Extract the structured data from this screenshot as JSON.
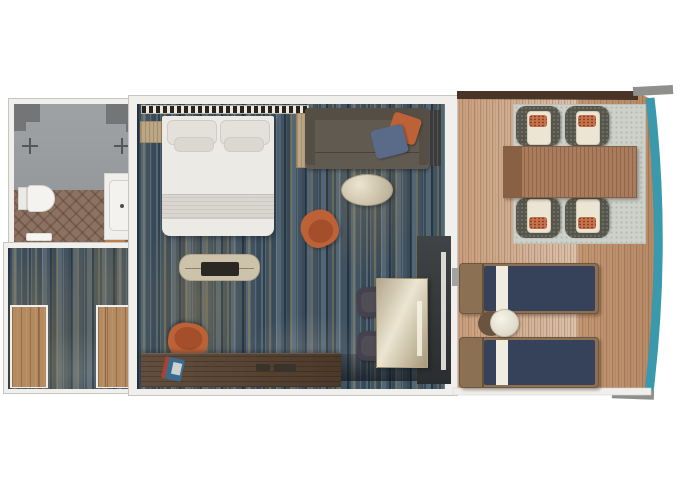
{
  "meta": {
    "type": "floor-plan-render",
    "view": "top-down 3D",
    "visible_text": "none"
  },
  "colors": {
    "bg": "#ffffff",
    "wall": "#f1efec",
    "wall-border": "#c7c5c1",
    "carpet": "#4e606f",
    "bath-floor": "#8c7261",
    "shower": "#9fa2a4",
    "shower-dark": "#737577",
    "threshold-wood": "#c08048",
    "closet-wood": "#b48b61",
    "bed": "#eceae5",
    "bed-shade": "#d9d6cf",
    "sofa": "#615a50",
    "sofa-dark": "#544e44",
    "orange": "#bd6136",
    "pillow-blue": "#596b88",
    "cream": "#cdc3ab",
    "tv": "#2b2824",
    "desk-wood": "#57412e",
    "stool": "#46424d",
    "glass": "#35383b",
    "deck": "#c69d7b",
    "teal": "#3b99ae",
    "brown-band": "#483527",
    "metal": "#8f8f8d",
    "rug": "#cdd1ca",
    "table-wood": "#a97c5d",
    "wicker": "#56564c",
    "cushion": "#ece5d4",
    "pillow-orange": "#c4734c",
    "navy": "#36425a",
    "stripe-cream": "#f0ecdf",
    "frame-wood": "#8c7053"
  },
  "floor_plan": {
    "rooms": [
      {
        "name": "bathroom",
        "items": [
          "shower area",
          "shower valve left",
          "shower valve right",
          "shelf block left",
          "shelf block right",
          "toilet",
          "bath mat",
          "vanity door",
          "wood threshold"
        ]
      },
      {
        "name": "entry hall",
        "items": [
          "carpet",
          "wardrobe left",
          "wardrobe right"
        ]
      },
      {
        "name": "bedroom living area",
        "items": [
          "headboard panel",
          "nightstand",
          "wardrobe cabinet",
          "double bed",
          "pillows x4",
          "blanket",
          "tv bench",
          "tv",
          "sofa",
          "orange throw pillow",
          "blue throw pillow",
          "curtain",
          "oval coffee table",
          "swivel armchair",
          "desk",
          "desk chair",
          "magazine",
          "desk accessories",
          "glossy vanity table",
          "stool upper",
          "stool lower",
          "sliding glass door",
          "sheer curtain"
        ]
      },
      {
        "name": "balcony",
        "items": [
          "wood deck",
          "partition rail top",
          "deck trim top-right",
          "deck trim bottom-right",
          "hull edge teal",
          "outdoor rug",
          "dining table",
          "wicker chair x4",
          "sun lounger x2",
          "round side table",
          "door threshold"
        ]
      }
    ]
  }
}
